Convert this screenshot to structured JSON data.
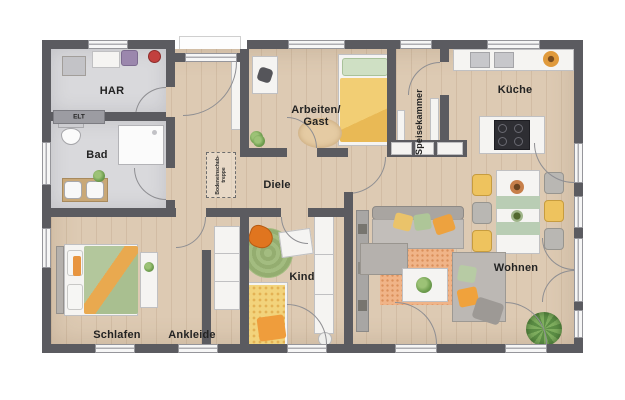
{
  "plan": {
    "type": "floor-plan",
    "language": "de",
    "rooms": {
      "har": {
        "label": "HAR"
      },
      "elt": {
        "label": "ELT"
      },
      "bad": {
        "label": "Bad"
      },
      "arbeiten_gast": {
        "label_line1": "Arbeiten/",
        "label_line2": "Gast"
      },
      "speisekammer": {
        "label": "Speisekammer"
      },
      "kueche": {
        "label": "Küche"
      },
      "diele": {
        "label": "Diele"
      },
      "schlafen": {
        "label": "Schlafen"
      },
      "ankleide": {
        "label": "Ankleide"
      },
      "kind": {
        "label": "Kind"
      },
      "wohnen": {
        "label": "Wohnen"
      }
    },
    "annotations": {
      "attic_stairs": {
        "label_line1": "Bodeneinschub-",
        "label_line2": "treppe"
      }
    },
    "colors": {
      "wall": "#5b5b60",
      "wood_floor": "#ddcab3",
      "tile_floor": "#d9d9dc",
      "accent_orange": "#e89a3e",
      "accent_green": "#aec698",
      "accent_yellow": "#eec35e"
    }
  }
}
